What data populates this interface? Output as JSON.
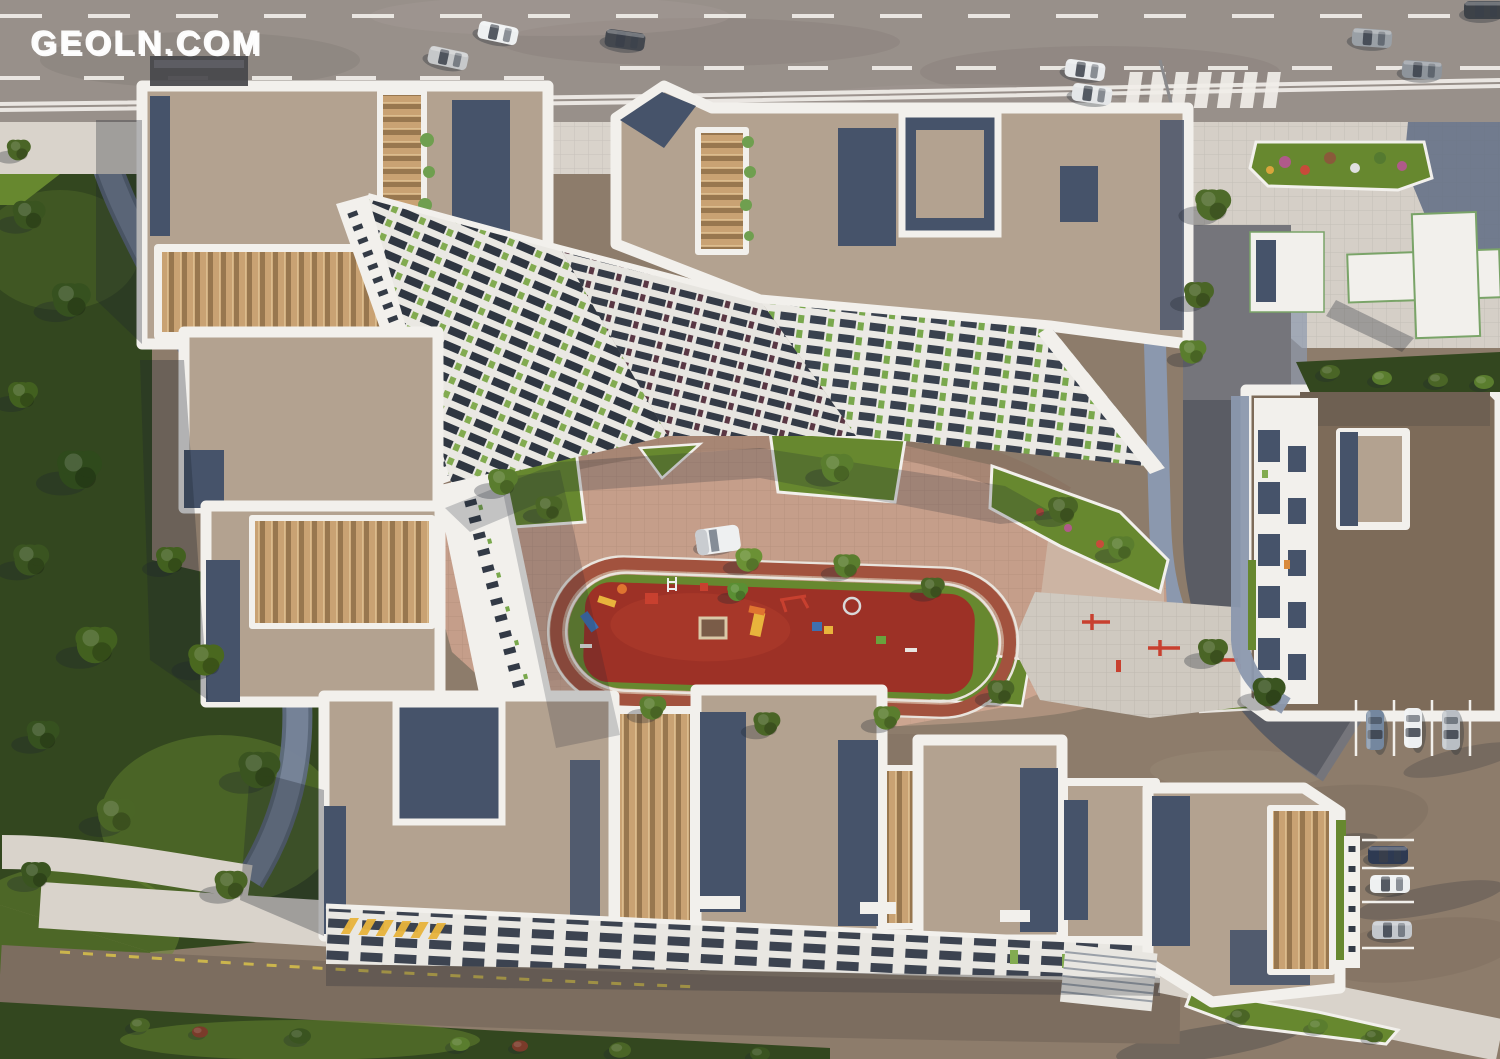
{
  "watermark": {
    "text": "GEOLN.COM"
  },
  "scene": {
    "type": "aerial-3d-render",
    "subject": "residential complex master plan with central courtyard playground"
  },
  "palette": {
    "road": "#98908a",
    "road-line": "#f1eee9",
    "sidewalk": "#d9d3cb",
    "plaza": "#d5cfc7",
    "tile-path": "#8b98ae",
    "tile-path-dark": "#5f6c84",
    "dirt": "#8d7c6b",
    "dirt-dark": "#6e6052",
    "grass-lit": "#67882f",
    "grass-dark": "#33471f",
    "roof-tan": "#b3a290",
    "roof-brown": "#7d6b59",
    "slate": "#46536a",
    "white": "#f2f0ec",
    "wood": "#c9a273",
    "wood-stripe": "#8f7049",
    "window-dark": "#2f3641",
    "accent-green": "#82ab50",
    "paving-pink": "#c59e8a",
    "paving-shadow": "#8a6d5e",
    "playground-red": "#9d3126",
    "track": "#a2523e",
    "equip-yellow": "#e8b43c",
    "equip-orange": "#df7430",
    "equip-blue": "#3e6fb0",
    "equip-red": "#c8402f",
    "shadow": "#1d2430"
  }
}
